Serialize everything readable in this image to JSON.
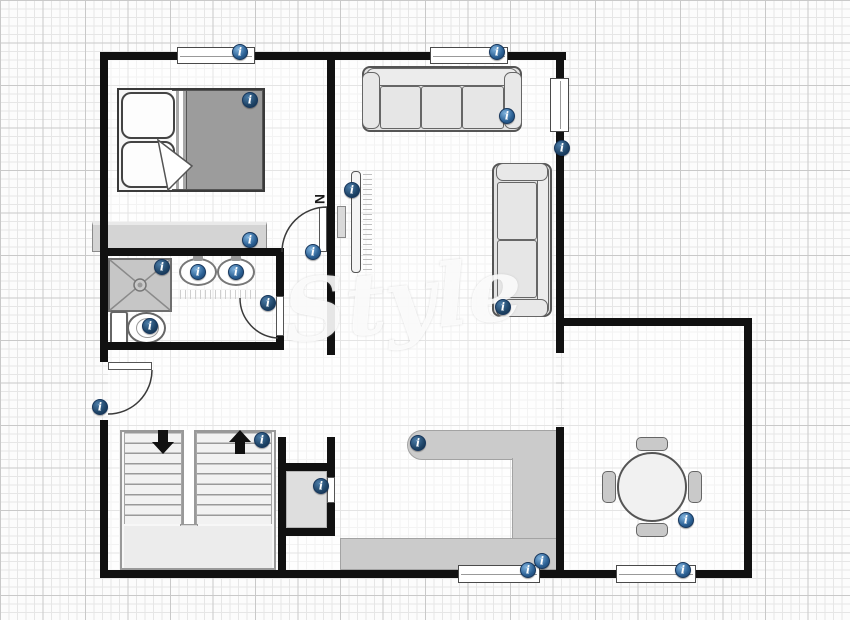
{
  "compass": {
    "label": "N"
  },
  "watermark": {
    "text": "Style"
  },
  "marker_glyph": "i",
  "colors": {
    "wall": "#111111",
    "marker_blue": "#2a5f93",
    "marker_dark_blue": "#1f4568",
    "counter_gray": "#cbcbcb",
    "blanket_gray": "#9c9c9c",
    "grid_minor": "#e6e6e6",
    "grid_major": "#c9c9c9"
  },
  "rooms": [
    "bedroom",
    "bathroom",
    "living-room",
    "hallway",
    "stairwell",
    "closet",
    "kitchen",
    "dining-area"
  ],
  "markers": [
    {
      "name": "window-bedroom-info",
      "x": 240,
      "y": 52,
      "variant": "light"
    },
    {
      "name": "bed-info",
      "x": 250,
      "y": 100,
      "variant": "dark"
    },
    {
      "name": "dresser-info",
      "x": 250,
      "y": 240,
      "variant": "light"
    },
    {
      "name": "window-living-info",
      "x": 497,
      "y": 52,
      "variant": "light"
    },
    {
      "name": "sofa-top-info",
      "x": 507,
      "y": 116,
      "variant": "light"
    },
    {
      "name": "window-right-info",
      "x": 562,
      "y": 148,
      "variant": "dark"
    },
    {
      "name": "tv-info",
      "x": 352,
      "y": 190,
      "variant": "dark"
    },
    {
      "name": "sofa-right-info",
      "x": 503,
      "y": 307,
      "variant": "dark"
    },
    {
      "name": "bedroom-door-info",
      "x": 313,
      "y": 252,
      "variant": "light"
    },
    {
      "name": "shower-info",
      "x": 162,
      "y": 267,
      "variant": "dark"
    },
    {
      "name": "sink-left-info",
      "x": 198,
      "y": 272,
      "variant": "light"
    },
    {
      "name": "sink-right-info",
      "x": 236,
      "y": 272,
      "variant": "light"
    },
    {
      "name": "toilet-info",
      "x": 150,
      "y": 326,
      "variant": "dark"
    },
    {
      "name": "bathroom-door-info",
      "x": 268,
      "y": 303,
      "variant": "dark"
    },
    {
      "name": "entry-door-info",
      "x": 100,
      "y": 407,
      "variant": "dark"
    },
    {
      "name": "stairs-info",
      "x": 262,
      "y": 440,
      "variant": "dark"
    },
    {
      "name": "closet-info",
      "x": 321,
      "y": 486,
      "variant": "dark"
    },
    {
      "name": "kitchen-counter-info",
      "x": 418,
      "y": 443,
      "variant": "dark"
    },
    {
      "name": "kitchen-info",
      "x": 542,
      "y": 561,
      "variant": "light"
    },
    {
      "name": "kitchen-window-info",
      "x": 528,
      "y": 570,
      "variant": "light"
    },
    {
      "name": "dining-table-info",
      "x": 686,
      "y": 520,
      "variant": "light"
    },
    {
      "name": "dining-window-info",
      "x": 683,
      "y": 570,
      "variant": "light"
    }
  ]
}
